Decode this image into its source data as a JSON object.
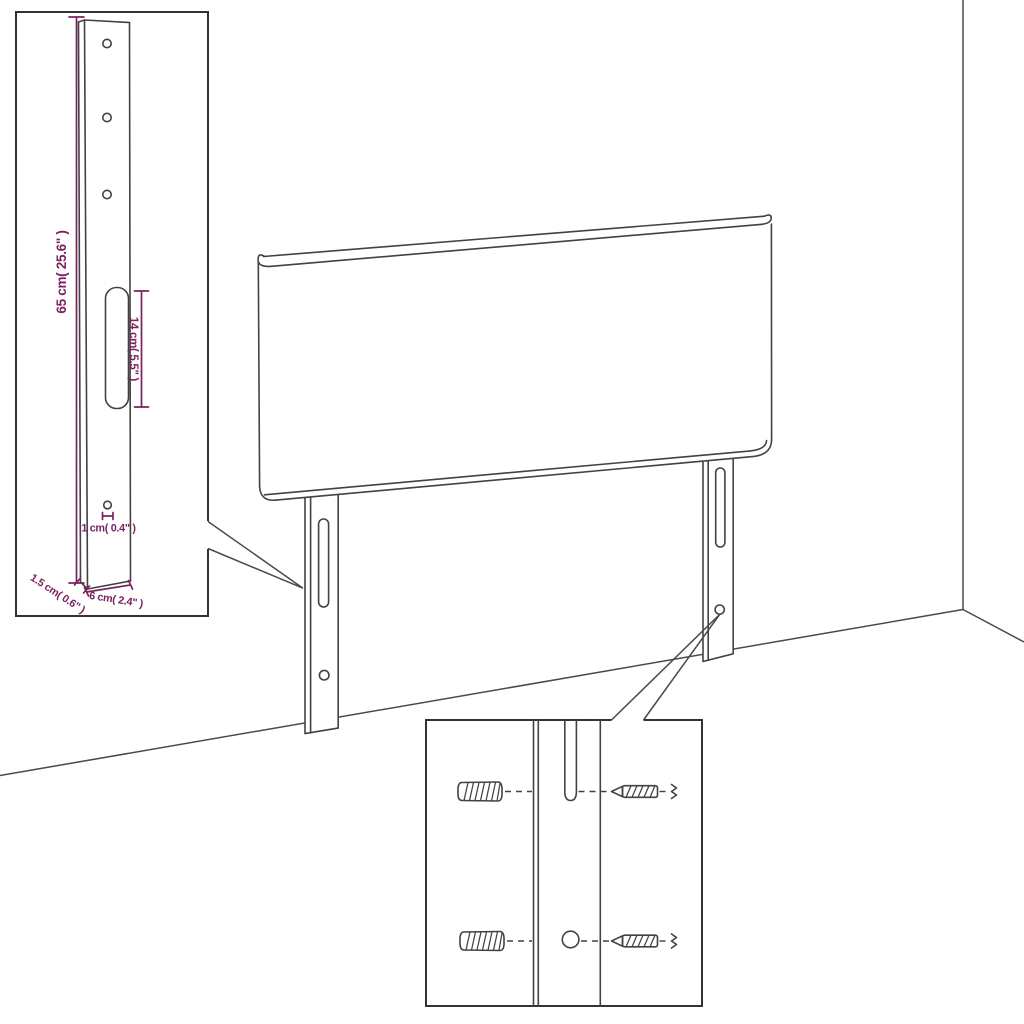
{
  "colors": {
    "accent": "#7b2161",
    "line": "#424242",
    "inset_border": "#333333",
    "background": "#ffffff"
  },
  "dimensions": {
    "leg_height": "65 cm( 25.6\" )",
    "slot_length": "14 cm( 5.5\" )",
    "hole_diameter": "1 cm( 0.4\" )",
    "side_thickness": "1.5 cm( 0.6\" )",
    "leg_width": "6 cm( 2.4\" )"
  },
  "icons": {
    "wall_plug": "wall-plug-symbol",
    "screw": "screw-symbol",
    "leg_slot": "slot-cutout",
    "leg_hole": "round-hole"
  }
}
